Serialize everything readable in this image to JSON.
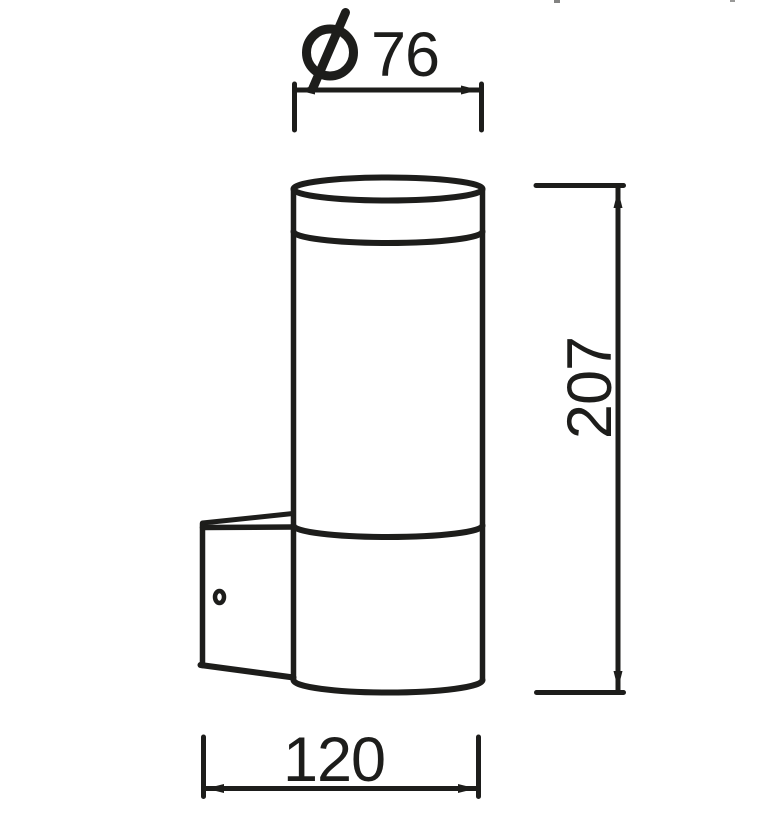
{
  "figure": {
    "background": "#ffffff",
    "line_color": "#1d1d1b",
    "dimensions": {
      "diameter": {
        "symbol": "Ø",
        "value": "76"
      },
      "height": {
        "value": "207"
      },
      "width": {
        "value": "120"
      }
    }
  }
}
